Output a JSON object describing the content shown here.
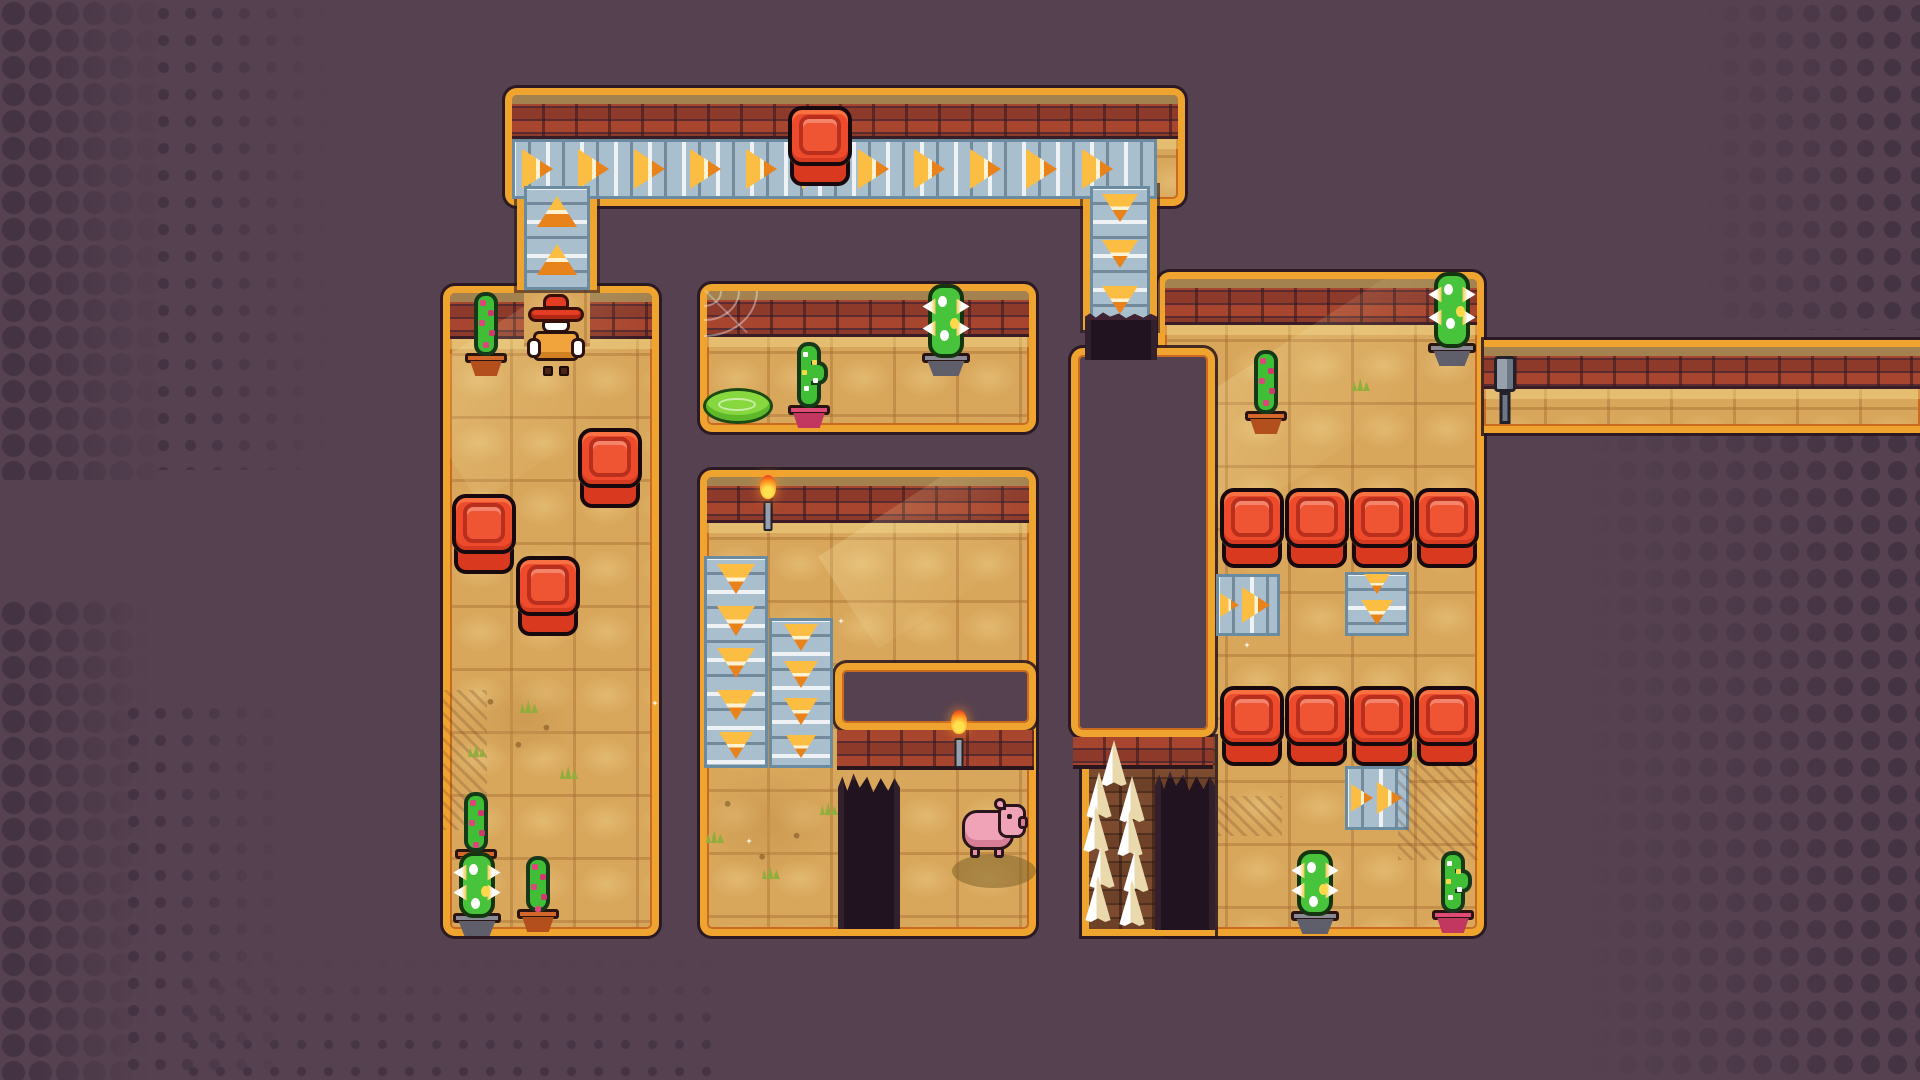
{
  "meta": {
    "app": "pixel-art top-down puzzle game level",
    "hud_text": "",
    "colors": {
      "background": "#554150",
      "halftone_dot": "#443343",
      "trim_orange": "#f0a430",
      "trim_inner": "#c96a20",
      "outline_dark": "#2a161e",
      "sand": "#d8a75c",
      "brick_red": "#a8452e",
      "brick_tan": "#a3824f",
      "belt_blue": "#a9bfce",
      "arrow_orange": "#fbbd42",
      "block_red": "#ee4b2c",
      "cactus_green": "#3fbe36",
      "spiky_green": "#47c43b",
      "pig_pink": "#f0a2b6",
      "spike_white": "#ffffff",
      "pit_dark": "#221320"
    }
  },
  "scene": {
    "width": 1920,
    "height": 1080,
    "items": [
      {
        "t": "halftone",
        "n": "halftone-top-left-large",
        "x": 0,
        "y": 0,
        "w": 180,
        "h": 480,
        "cell": 27,
        "r": 11,
        "fade": "right"
      },
      {
        "t": "halftone",
        "n": "halftone-top-left-small",
        "x": 150,
        "y": 0,
        "w": 190,
        "h": 470,
        "cell": 27,
        "r": 5,
        "fade": "right"
      },
      {
        "t": "halftone",
        "n": "halftone-bottom-left-large",
        "x": 0,
        "y": 600,
        "w": 160,
        "h": 480,
        "cell": 27,
        "r": 11,
        "fade": "right"
      },
      {
        "t": "halftone",
        "n": "halftone-bottom-left-small",
        "x": 120,
        "y": 700,
        "w": 180,
        "h": 380,
        "cell": 27,
        "r": 5,
        "fade": "right"
      },
      {
        "t": "halftone",
        "n": "halftone-bottom-strip",
        "x": 180,
        "y": 950,
        "w": 540,
        "h": 130,
        "cell": 27,
        "r": 4,
        "fade": "top"
      },
      {
        "t": "halftone",
        "n": "halftone-top-right",
        "x": 1690,
        "y": 0,
        "w": 230,
        "h": 330,
        "cell": 27,
        "r": 8,
        "fade": "left"
      },
      {
        "t": "halftone",
        "n": "halftone-bottom-right",
        "x": 1560,
        "y": 430,
        "w": 360,
        "h": 650,
        "cell": 27,
        "r": 9,
        "fade": "left"
      },
      {
        "t": "room",
        "n": "room-corridor-top",
        "x": 505,
        "y": 88,
        "w": 680,
        "h": 118,
        "brick": 44
      },
      {
        "t": "room",
        "n": "room-left",
        "x": 443,
        "y": 286,
        "w": 216,
        "h": 650,
        "brick": 46
      },
      {
        "t": "room",
        "n": "room-mid-top",
        "x": 700,
        "y": 284,
        "w": 336,
        "h": 148,
        "brick": 46
      },
      {
        "t": "room",
        "n": "room-mid",
        "x": 700,
        "y": 470,
        "w": 336,
        "h": 466,
        "brick": 46
      },
      {
        "t": "room",
        "n": "room-right",
        "x": 1158,
        "y": 272,
        "w": 326,
        "h": 664,
        "brick": 46
      },
      {
        "t": "room",
        "n": "room-corridor-right",
        "x": 1484,
        "y": 340,
        "w": 436,
        "h": 93,
        "brick": 42,
        "nosides": true
      },
      {
        "t": "beam",
        "n": "light-beam",
        "parent": "room-right",
        "x": 0,
        "y": 30,
        "w": 380,
        "h": 120
      },
      {
        "t": "beam",
        "n": "light-beam",
        "parent": "room-left",
        "x": -30,
        "y": 10,
        "w": 260,
        "h": 140
      },
      {
        "t": "beam",
        "n": "light-beam",
        "parent": "room-mid",
        "x": 120,
        "y": 0,
        "w": 260,
        "h": 110
      },
      {
        "t": "spikearea",
        "n": "spike-pit-strip",
        "x": 1082,
        "y": 737,
        "w": 133,
        "h": 199
      },
      {
        "t": "patch",
        "n": "floor-patch-under-cowboy",
        "x": 524,
        "y": 283,
        "w": 66,
        "h": 64
      },
      {
        "t": "wall",
        "n": "wall-interior-mid-room",
        "x": 835,
        "y": 663,
        "w": 201,
        "h": 67,
        "face": 40
      },
      {
        "t": "wall",
        "n": "wall-central-chasm",
        "x": 1071,
        "y": 348,
        "w": 144,
        "h": 389,
        "face": 32
      },
      {
        "t": "shaft",
        "n": "conveyor-shaft-left",
        "x": 517,
        "y": 186,
        "w": 80,
        "h": 104
      },
      {
        "t": "shaft",
        "n": "conveyor-shaft-right",
        "x": 1083,
        "y": 186,
        "w": 74,
        "h": 144
      },
      {
        "t": "belt",
        "n": "conveyor-belt-right-corridor",
        "x": 512,
        "y": 139,
        "w": 645,
        "h": 60,
        "dir": "right",
        "arrows": [
          {
            "o": 10,
            "s": 40
          },
          {
            "o": 66,
            "s": 40
          },
          {
            "o": 122,
            "s": 40
          },
          {
            "o": 178,
            "s": 40
          },
          {
            "o": 234,
            "s": 40
          },
          {
            "o": 290,
            "s": 40
          },
          {
            "o": 346,
            "s": 40
          },
          {
            "o": 402,
            "s": 40
          },
          {
            "o": 458,
            "s": 40
          },
          {
            "o": 514,
            "s": 40
          },
          {
            "o": 570,
            "s": 40
          }
        ]
      },
      {
        "t": "belt",
        "n": "conveyor-belt-up-shaft",
        "x": 524,
        "y": 186,
        "w": 66,
        "h": 104,
        "dir": "up",
        "arrows": [
          {
            "o": 10,
            "s": 40
          },
          {
            "o": 58,
            "s": 40
          }
        ]
      },
      {
        "t": "belt",
        "n": "conveyor-belt-down-shaft",
        "x": 1090,
        "y": 186,
        "w": 60,
        "h": 144,
        "dir": "down",
        "arrows": [
          {
            "o": 8,
            "s": 36
          },
          {
            "o": 54,
            "s": 36
          },
          {
            "o": 100,
            "s": 36
          }
        ]
      },
      {
        "t": "belt",
        "n": "conveyor-belt-down-a",
        "x": 704,
        "y": 556,
        "w": 64,
        "h": 212,
        "dir": "down",
        "arrows": [
          {
            "o": 8,
            "s": 38
          },
          {
            "o": 50,
            "s": 38
          },
          {
            "o": 92,
            "s": 38
          },
          {
            "o": 134,
            "s": 38
          },
          {
            "o": 176,
            "s": 34
          }
        ]
      },
      {
        "t": "belt",
        "n": "conveyor-belt-down-b",
        "x": 769,
        "y": 618,
        "w": 64,
        "h": 150,
        "dir": "down",
        "arrows": [
          {
            "o": 6,
            "s": 34
          },
          {
            "o": 43,
            "s": 34
          },
          {
            "o": 80,
            "s": 34
          },
          {
            "o": 117,
            "s": 30
          }
        ]
      },
      {
        "t": "belt",
        "n": "conveyor-belt-right-1",
        "x": 1216,
        "y": 574,
        "w": 64,
        "h": 62,
        "dir": "right",
        "arrows": [
          {
            "o": 4,
            "s": 24
          },
          {
            "o": 26,
            "s": 36
          }
        ]
      },
      {
        "t": "belt",
        "n": "conveyor-belt-down-c",
        "x": 1345,
        "y": 572,
        "w": 64,
        "h": 64,
        "dir": "down",
        "arrows": [
          {
            "o": 2,
            "s": 26
          },
          {
            "o": 28,
            "s": 32
          }
        ]
      },
      {
        "t": "belt",
        "n": "conveyor-belt-right-2",
        "x": 1345,
        "y": 766,
        "w": 64,
        "h": 64,
        "dir": "right",
        "arrows": [
          {
            "o": 6,
            "s": 28
          },
          {
            "o": 32,
            "s": 32
          }
        ]
      },
      {
        "t": "pit",
        "n": "pit-shaft-mouth",
        "x": 1085,
        "y": 312,
        "w": 72,
        "h": 48
      },
      {
        "t": "pit",
        "n": "pit-floor-hole",
        "x": 838,
        "y": 772,
        "w": 62,
        "h": 157
      },
      {
        "t": "pit",
        "n": "pit-chasm-right-of-spikes",
        "x": 1155,
        "y": 770,
        "w": 60,
        "h": 160
      },
      {
        "t": "spike",
        "n": "floor-spike",
        "x": 1099,
        "y": 740
      },
      {
        "t": "spike",
        "n": "floor-spike",
        "x": 1084,
        "y": 772
      },
      {
        "t": "spike",
        "n": "floor-spike",
        "x": 1117,
        "y": 776
      },
      {
        "t": "spike",
        "n": "floor-spike",
        "x": 1081,
        "y": 806
      },
      {
        "t": "spike",
        "n": "floor-spike",
        "x": 1115,
        "y": 810
      },
      {
        "t": "spike",
        "n": "floor-spike",
        "x": 1087,
        "y": 842
      },
      {
        "t": "spike",
        "n": "floor-spike",
        "x": 1121,
        "y": 846
      },
      {
        "t": "spike",
        "n": "floor-spike",
        "x": 1083,
        "y": 876
      },
      {
        "t": "spike",
        "n": "floor-spike",
        "x": 1117,
        "y": 880
      },
      {
        "t": "hatch",
        "n": "shade-hatch",
        "x": 443,
        "y": 690,
        "w": 44,
        "h": 140
      },
      {
        "t": "hatch",
        "n": "shade-hatch",
        "x": 1398,
        "y": 760,
        "w": 80,
        "h": 100
      },
      {
        "t": "hatch",
        "n": "shade-hatch",
        "x": 1218,
        "y": 796,
        "w": 64,
        "h": 40
      },
      {
        "t": "dirt",
        "n": "dirt-patch",
        "x": 468,
        "y": 676,
        "w": 112,
        "h": 86
      },
      {
        "t": "dirt",
        "n": "dirt-patch",
        "x": 700,
        "y": 772,
        "w": 138,
        "h": 106
      },
      {
        "t": "grass",
        "n": "grass-tuft",
        "x": 520,
        "y": 700
      },
      {
        "t": "grass",
        "n": "grass-tuft",
        "x": 468,
        "y": 744
      },
      {
        "t": "grass",
        "n": "grass-tuft",
        "x": 560,
        "y": 766
      },
      {
        "t": "grass",
        "n": "grass-tuft",
        "x": 706,
        "y": 830
      },
      {
        "t": "grass",
        "n": "grass-tuft",
        "x": 762,
        "y": 866
      },
      {
        "t": "grass",
        "n": "grass-tuft",
        "x": 820,
        "y": 802
      },
      {
        "t": "grass",
        "n": "grass-tuft",
        "x": 1352,
        "y": 378
      },
      {
        "t": "grass",
        "n": "grass-tuft",
        "x": 1398,
        "y": 744
      },
      {
        "t": "sparkle",
        "n": "sand-sparkle",
        "x": 746,
        "y": 838
      },
      {
        "t": "sparkle",
        "n": "sand-sparkle",
        "x": 838,
        "y": 618
      },
      {
        "t": "sparkle",
        "n": "sand-sparkle",
        "x": 1244,
        "y": 642
      },
      {
        "t": "sparkle",
        "n": "sand-sparkle",
        "x": 652,
        "y": 700
      },
      {
        "t": "web",
        "n": "spider-web",
        "x": 704,
        "y": 291,
        "w": 54,
        "h": 46
      },
      {
        "t": "slime",
        "n": "slime-puddle",
        "x": 703,
        "y": 388,
        "w": 70,
        "h": 36
      },
      {
        "t": "mud",
        "n": "mud-puddle",
        "x": 952,
        "y": 854,
        "w": 84,
        "h": 34
      },
      {
        "t": "torch",
        "n": "wall-torch",
        "x": 757,
        "y": 475,
        "w": 22,
        "h": 56
      },
      {
        "t": "torch",
        "n": "wall-torch",
        "x": 948,
        "y": 710,
        "w": 22,
        "h": 58
      },
      {
        "t": "lever",
        "n": "lever-pipe",
        "x": 1492,
        "y": 356,
        "w": 26,
        "h": 68
      },
      {
        "t": "block",
        "n": "red-block",
        "x": 788,
        "y": 106,
        "w": 64,
        "h": 80
      },
      {
        "t": "block",
        "n": "red-block",
        "x": 578,
        "y": 428,
        "w": 64,
        "h": 80
      },
      {
        "t": "block",
        "n": "red-block",
        "x": 452,
        "y": 494,
        "w": 64,
        "h": 80
      },
      {
        "t": "block",
        "n": "red-block",
        "x": 516,
        "y": 556,
        "w": 64,
        "h": 80
      },
      {
        "t": "block",
        "n": "red-block",
        "x": 1220,
        "y": 488,
        "w": 64,
        "h": 80
      },
      {
        "t": "block",
        "n": "red-block",
        "x": 1285,
        "y": 488,
        "w": 64,
        "h": 80
      },
      {
        "t": "block",
        "n": "red-block",
        "x": 1350,
        "y": 488,
        "w": 64,
        "h": 80
      },
      {
        "t": "block",
        "n": "red-block",
        "x": 1415,
        "y": 488,
        "w": 64,
        "h": 80
      },
      {
        "t": "block",
        "n": "red-block",
        "x": 1220,
        "y": 686,
        "w": 64,
        "h": 80
      },
      {
        "t": "block",
        "n": "red-block",
        "x": 1285,
        "y": 686,
        "w": 64,
        "h": 80
      },
      {
        "t": "block",
        "n": "red-block",
        "x": 1350,
        "y": 686,
        "w": 64,
        "h": 80
      },
      {
        "t": "block",
        "n": "red-block",
        "x": 1415,
        "y": 686,
        "w": 64,
        "h": 80
      },
      {
        "t": "cactus",
        "n": "potted-cactus",
        "x": 462,
        "y": 292,
        "w": 48,
        "h": 84,
        "pot": "pot-orange",
        "flowers": true
      },
      {
        "t": "cactus",
        "n": "potted-cactus",
        "x": 782,
        "y": 342,
        "w": 54,
        "h": 86,
        "pot": "pot-pink",
        "dots": true,
        "arm": true
      },
      {
        "t": "cactus",
        "n": "potted-cactus",
        "x": 1240,
        "y": 350,
        "w": 52,
        "h": 84,
        "pot": "pot-orange",
        "flowers": true
      },
      {
        "t": "cactus",
        "n": "potted-cactus",
        "x": 452,
        "y": 792,
        "w": 48,
        "h": 80,
        "pot": "pot-orange",
        "flowers": true
      },
      {
        "t": "cactus",
        "n": "potted-cactus",
        "x": 515,
        "y": 856,
        "w": 46,
        "h": 76,
        "pot": "pot-orange",
        "flowers": true
      },
      {
        "t": "cactus",
        "n": "potted-cactus",
        "x": 1426,
        "y": 851,
        "w": 54,
        "h": 82,
        "pot": "pot-pink",
        "dots": true,
        "arm": true
      },
      {
        "t": "spiky",
        "n": "spiky-cactus",
        "x": 917,
        "y": 282,
        "w": 58,
        "h": 94
      },
      {
        "t": "spiky",
        "n": "spiky-cactus",
        "x": 1423,
        "y": 270,
        "w": 58,
        "h": 96
      },
      {
        "t": "spiky",
        "n": "spiky-cactus",
        "x": 447,
        "y": 850,
        "w": 60,
        "h": 86
      },
      {
        "t": "spiky",
        "n": "spiky-cactus",
        "x": 1285,
        "y": 848,
        "w": 60,
        "h": 86
      },
      {
        "t": "cowboy",
        "n": "player-cowboy",
        "x": 527,
        "y": 294,
        "w": 58,
        "h": 82
      },
      {
        "t": "pig",
        "n": "pig",
        "x": 962,
        "y": 796,
        "w": 66,
        "h": 62
      }
    ]
  }
}
